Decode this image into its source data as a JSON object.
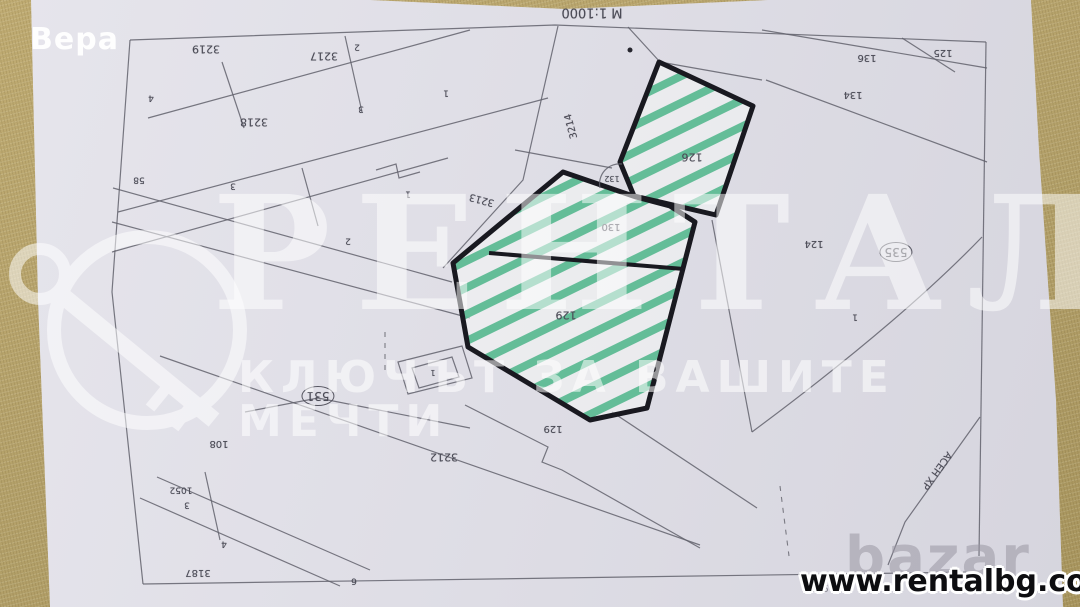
{
  "photo_label": "Вера",
  "map": {
    "scale_label": "М 1:1000",
    "highlighted_plots": [
      "126",
      "130",
      "129"
    ],
    "circled_numbers": [
      "535",
      "531"
    ],
    "labels": [
      {
        "t": "М 1:1000",
        "x": 592,
        "y": 12,
        "s": 13,
        "name": "scale-label"
      },
      {
        "t": "3219",
        "x": 206,
        "y": 49,
        "s": 11
      },
      {
        "t": "2",
        "x": 357,
        "y": 46,
        "s": 9
      },
      {
        "t": "3217",
        "x": 324,
        "y": 56,
        "s": 11
      },
      {
        "t": "4",
        "x": 151,
        "y": 97,
        "s": 9
      },
      {
        "t": "1",
        "x": 446,
        "y": 92,
        "s": 9
      },
      {
        "t": "3",
        "x": 361,
        "y": 108,
        "s": 9
      },
      {
        "t": "3218",
        "x": 254,
        "y": 122,
        "s": 11
      },
      {
        "t": "58",
        "x": 139,
        "y": 179,
        "s": 9
      },
      {
        "t": "3",
        "x": 233,
        "y": 185,
        "s": 9
      },
      {
        "t": "1",
        "x": 408,
        "y": 193,
        "s": 9
      },
      {
        "t": "2",
        "x": 348,
        "y": 240,
        "s": 9
      },
      {
        "t": "3214",
        "x": 572,
        "y": 126,
        "s": 10,
        "r": 255
      },
      {
        "t": "3213",
        "x": 482,
        "y": 199,
        "s": 10,
        "r": 195
      },
      {
        "t": "126",
        "x": 692,
        "y": 157,
        "s": 11,
        "name": "highlighted-plot-126-label"
      },
      {
        "t": "132",
        "x": 612,
        "y": 178,
        "s": 8
      },
      {
        "t": "130",
        "x": 611,
        "y": 226,
        "s": 10,
        "name": "highlighted-plot-130-label"
      },
      {
        "t": "129",
        "x": 566,
        "y": 315,
        "s": 11,
        "name": "highlighted-plot-129-label"
      },
      {
        "t": "136",
        "x": 867,
        "y": 57,
        "s": 10
      },
      {
        "t": "125",
        "x": 943,
        "y": 52,
        "s": 10
      },
      {
        "t": "134",
        "x": 853,
        "y": 94,
        "s": 10
      },
      {
        "t": "124",
        "x": 814,
        "y": 243,
        "s": 10
      },
      {
        "t": "535",
        "x": 896,
        "y": 252,
        "s": 12,
        "kind": "circled",
        "name": "circled-number-535"
      },
      {
        "t": "1",
        "x": 855,
        "y": 316,
        "s": 9
      },
      {
        "t": "531",
        "x": 318,
        "y": 396,
        "s": 12,
        "kind": "circled",
        "name": "circled-number-531"
      },
      {
        "t": "108",
        "x": 219,
        "y": 443,
        "s": 10
      },
      {
        "t": "3212",
        "x": 444,
        "y": 457,
        "s": 11
      },
      {
        "t": "1052",
        "x": 181,
        "y": 489,
        "s": 9
      },
      {
        "t": "3",
        "x": 187,
        "y": 504,
        "s": 9
      },
      {
        "t": "4",
        "x": 224,
        "y": 543,
        "s": 9
      },
      {
        "t": "3187",
        "x": 198,
        "y": 572,
        "s": 10
      },
      {
        "t": "6",
        "x": 354,
        "y": 580,
        "s": 9
      },
      {
        "t": "129",
        "x": 553,
        "y": 428,
        "s": 10
      },
      {
        "t": "1",
        "x": 433,
        "y": 372,
        "s": 8
      },
      {
        "t": "1970г.",
        "x": 818,
        "y": 587,
        "s": 10,
        "kind": "muted",
        "name": "year-label"
      },
      {
        "t": "АСЕН ХР",
        "x": 936,
        "y": 470,
        "s": 10,
        "r": 126,
        "name": "street-name-label"
      }
    ]
  },
  "watermark": {
    "brand": "РЕНТАЛ",
    "tagline": "КЛЮЧЪТ ЗА ВАШИТЕ МЕЧТИ",
    "logo": "key-in-circle"
  },
  "footer": {
    "site": "www.rentalbg.com",
    "marketplace_watermark": "bazar"
  },
  "colors": {
    "fabric": "#b3a069",
    "paper": "#dfdee6",
    "map_line": "#61616c",
    "plot_outline": "#191920",
    "hatch_green": "#4db58a",
    "watermark_white": "rgba(255,255,255,0.55)"
  }
}
